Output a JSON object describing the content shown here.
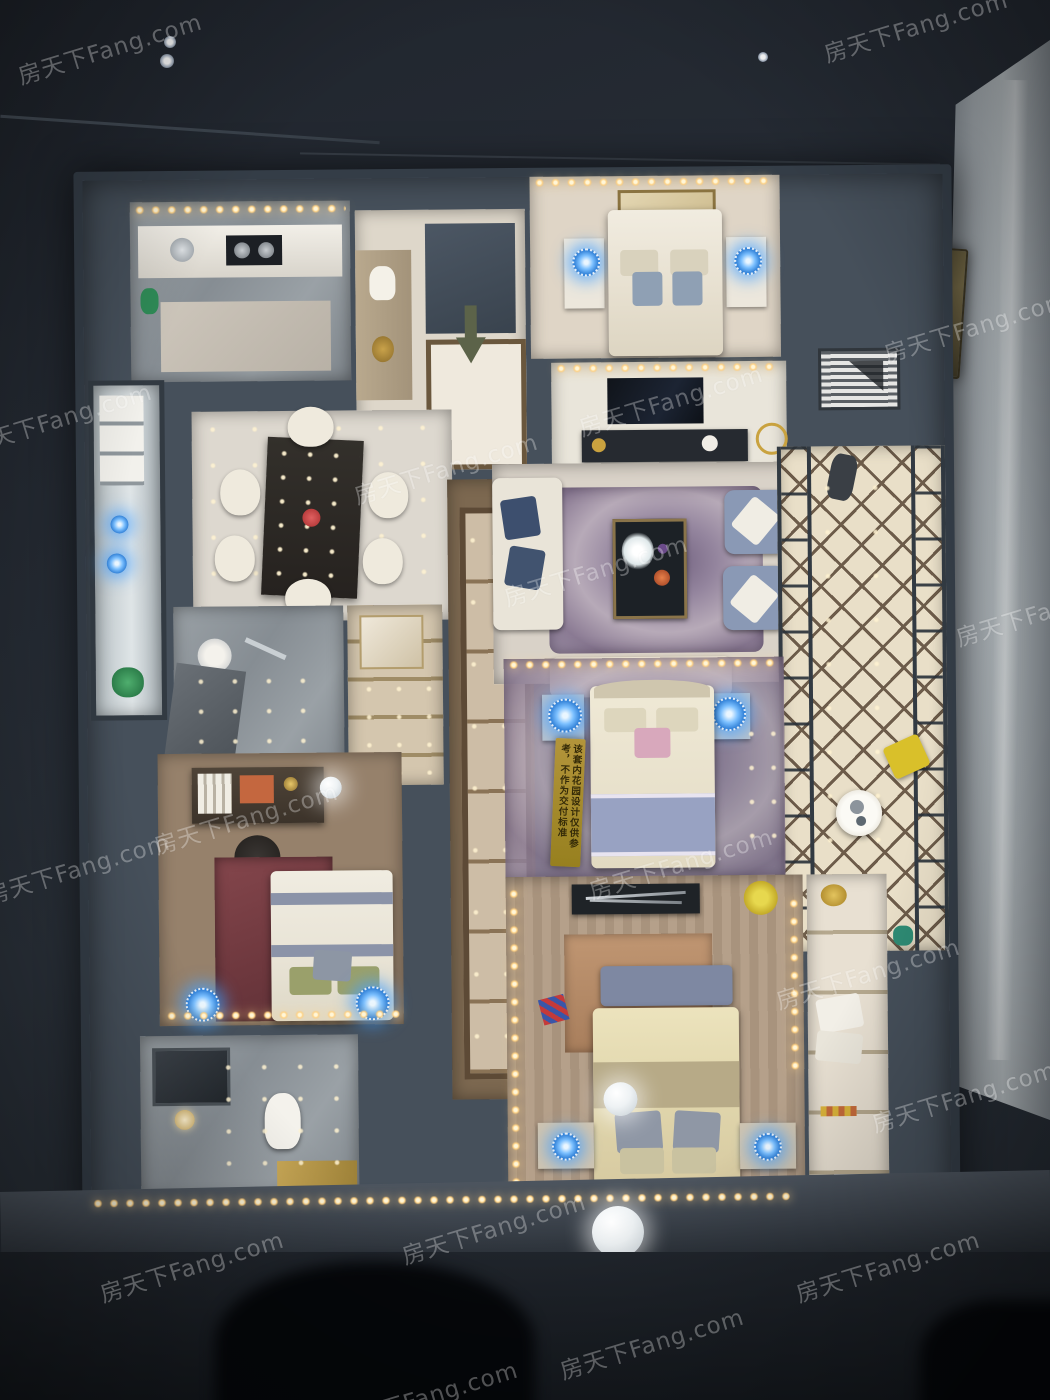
{
  "photo": {
    "subject": "top-down architectural scale model of an apartment inside a glass display case",
    "watermark": {
      "text": "房天下Fang.com",
      "color": "#ffffff",
      "opacity": 0.3,
      "rotation_deg": -17,
      "positions": [
        [
          14,
          30
        ],
        [
          820,
          8
        ],
        [
          -36,
          400
        ],
        [
          500,
          552
        ],
        [
          952,
          592
        ],
        [
          575,
          382
        ],
        [
          350,
          450
        ],
        [
          150,
          800
        ],
        [
          585,
          845
        ],
        [
          -18,
          850
        ],
        [
          772,
          955
        ],
        [
          868,
          1078
        ],
        [
          398,
          1210
        ],
        [
          96,
          1248
        ],
        [
          792,
          1248
        ],
        [
          556,
          1325
        ],
        [
          330,
          1378
        ],
        [
          880,
          308
        ]
      ]
    },
    "signs": {
      "garden_notice": {
        "line1": "该套内花园设计仅供参考，",
        "line2": "不作为交付标准",
        "bg_color": "#b3953b",
        "text_color": "#352b08"
      },
      "brass_plaque": {
        "bg_color": "#7d714c",
        "text_legible": false
      }
    },
    "lights": {
      "led_strip_color": "#ffd488",
      "bedside_lamp_color": "#44a4ff",
      "sparkle_color": "#fff3d2"
    },
    "palette": {
      "case_dark": "#232830",
      "wall_slate": "#46505b",
      "floor_marble": "#d6cfc4",
      "floor_wood": "#8d7458",
      "rug_purple": "#8c7d97",
      "bed_cream": "#e9e1cd",
      "armchair_blue": "#8a99b5",
      "glass_gray": "#aeb5ba",
      "accent_red_rug": "#7c3f44",
      "yellow_flowers": "#d9c637"
    }
  }
}
